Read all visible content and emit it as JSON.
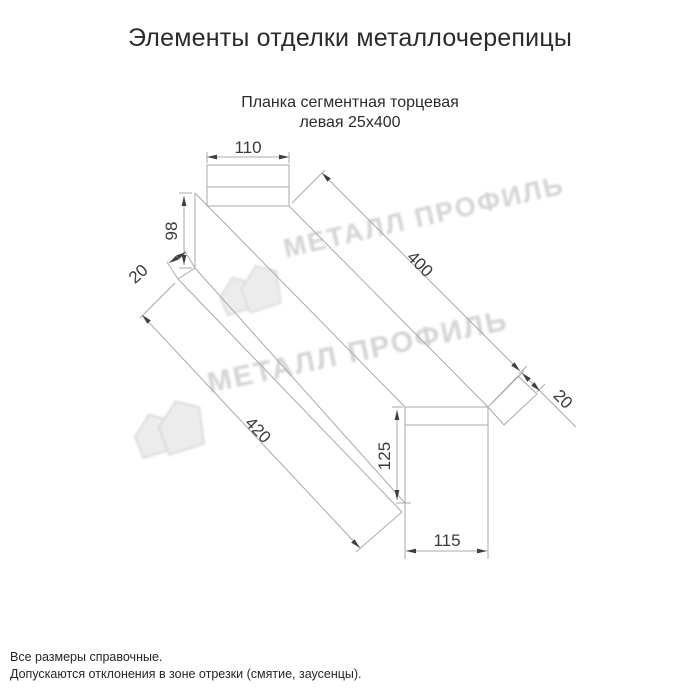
{
  "page": {
    "title": "Элементы отделки металлочерепицы",
    "subtitle_line1": "Планка сегментная торцевая",
    "subtitle_line2": "левая 25х400",
    "footnote_line1": "Все размеры справочные.",
    "footnote_line2": "Допускаются отклонения в зоне отрезки (смятие, заусенцы)."
  },
  "watermark": {
    "text": "МЕТАЛЛ ПРОФИЛЬ",
    "logo": "metal-profil-logo",
    "text_color": "#d4d4d4"
  },
  "drawing": {
    "part_name": "Планка сегментная торцевая левая 25х400",
    "line_color": "#a6aab0",
    "label_color": "#3a3a3a",
    "dimensions": {
      "top_width": "110",
      "near_height": "98",
      "near_flange": "20",
      "length_top": "400",
      "length_bottom": "420",
      "far_flange": "20",
      "far_height": "125",
      "far_width": "115"
    }
  }
}
